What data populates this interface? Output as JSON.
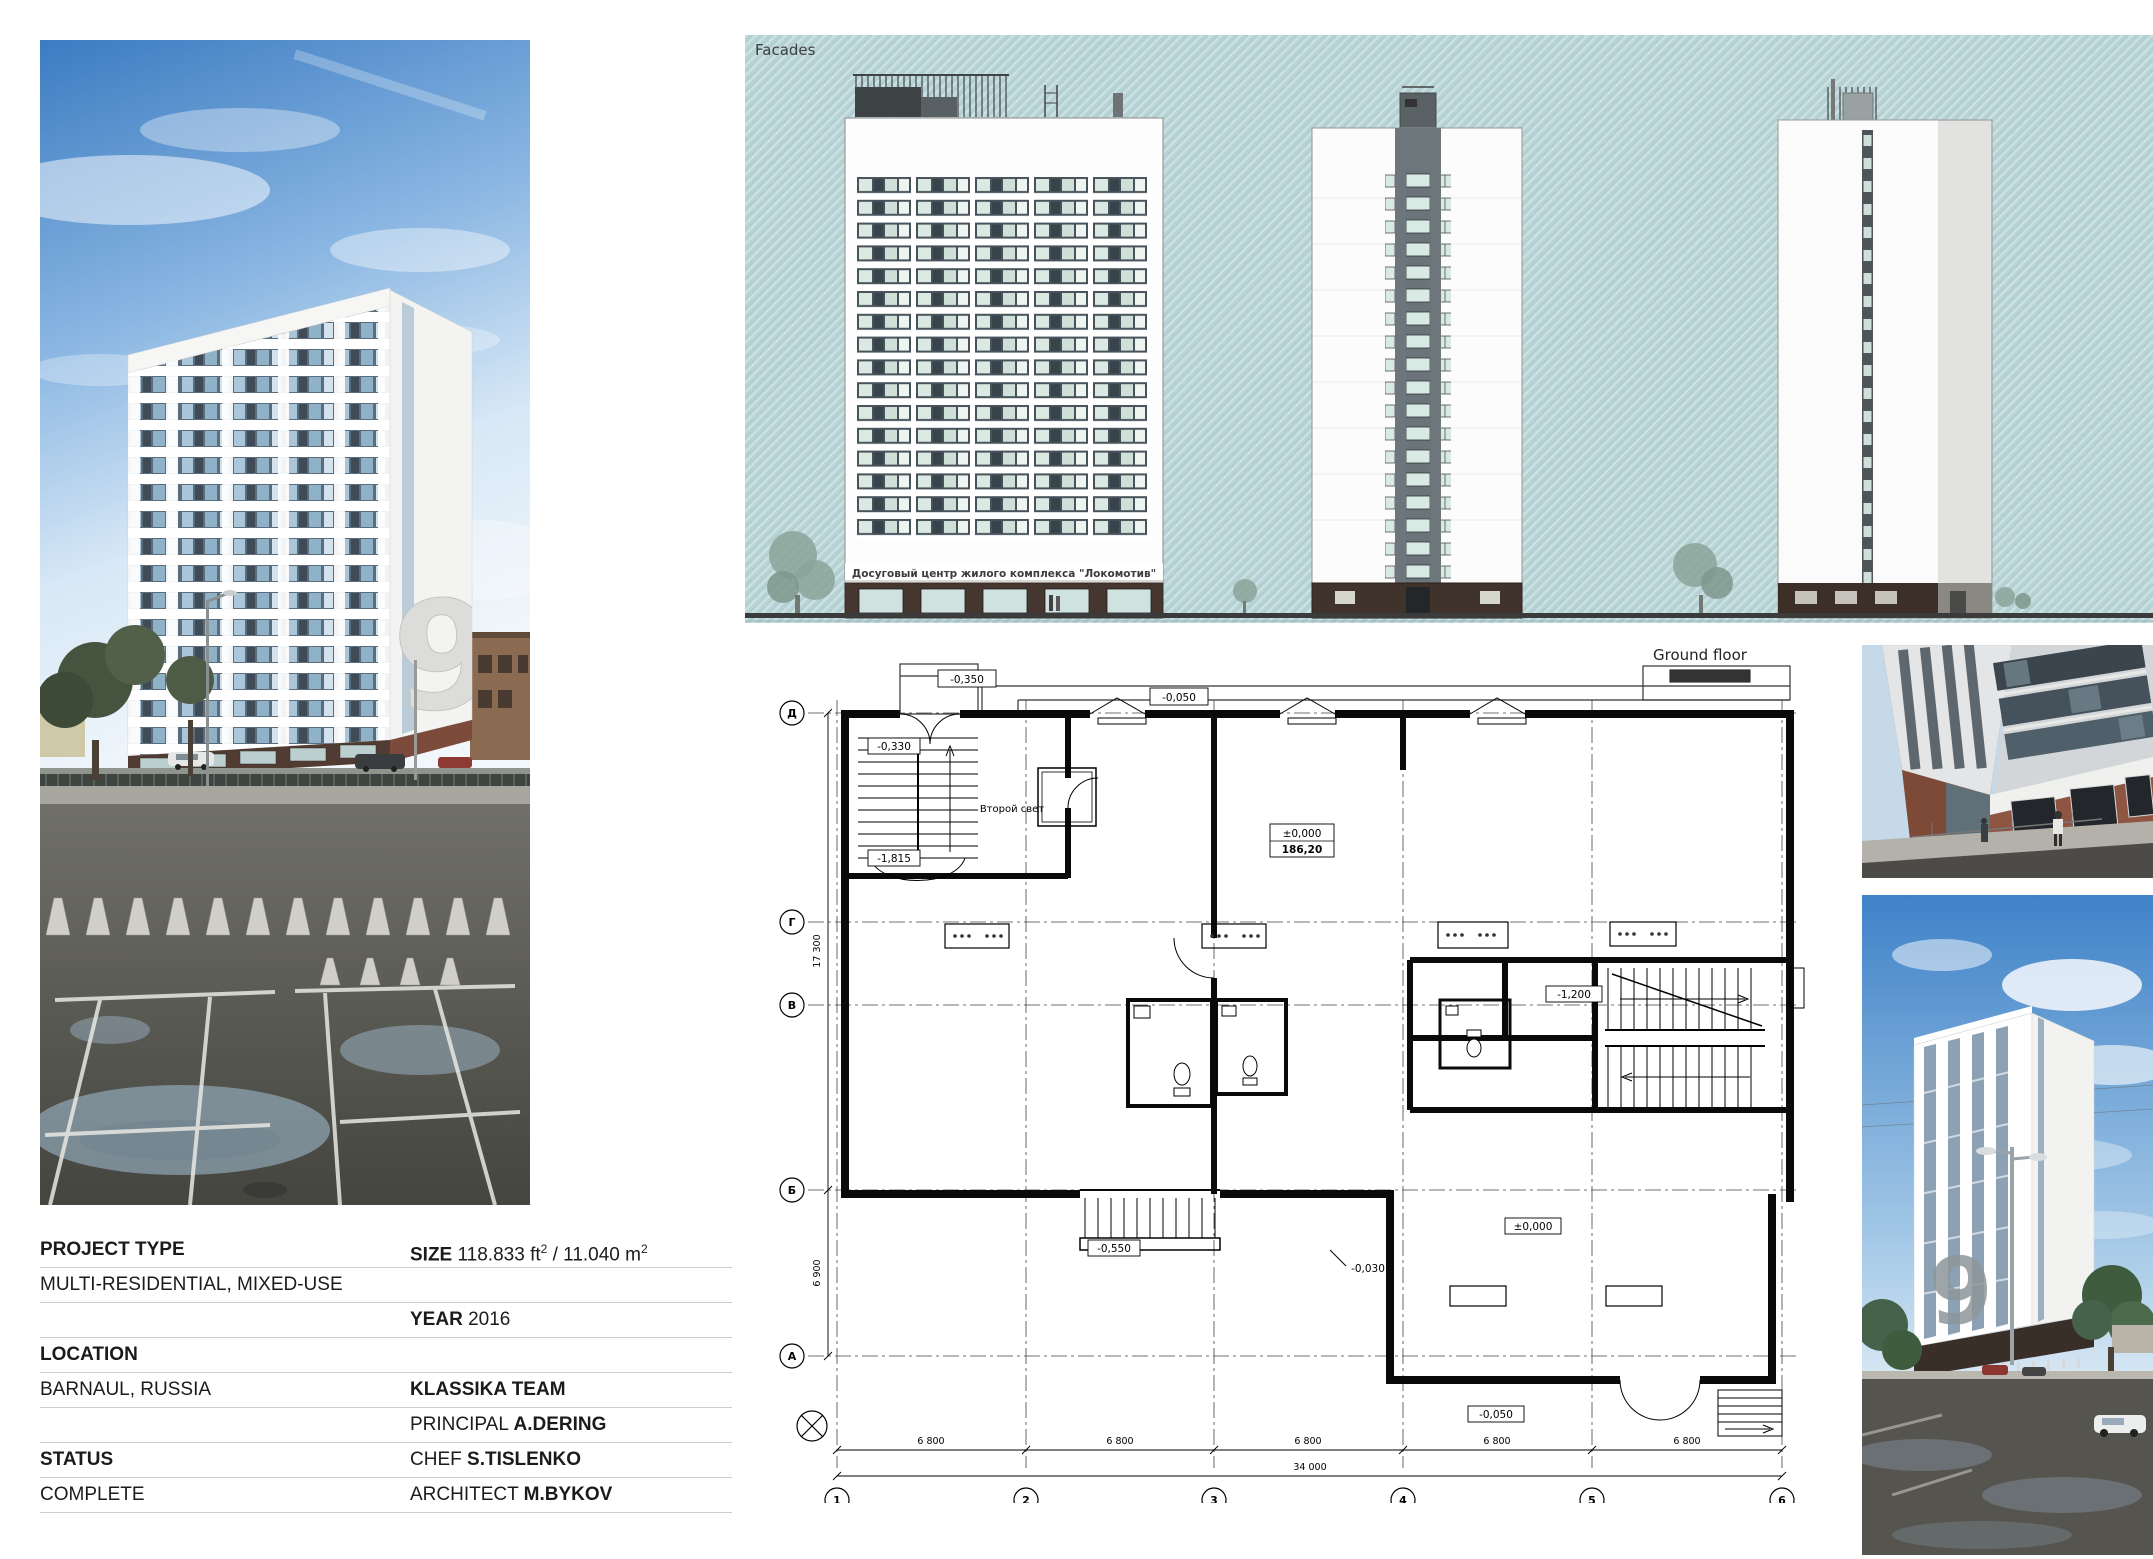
{
  "facades": {
    "title": "Facades",
    "caption": "Досуговый центр жилого комплекса \"Локомотив\""
  },
  "plan": {
    "title": "Ground floor",
    "room_label": "Второй свет",
    "levels": {
      "l1": "-0,350",
      "l2": "-0,050",
      "l3": "-0,330",
      "l4": "-1,815",
      "l5": "±0,000",
      "l5b": "186,20",
      "l6": "-1,200",
      "l7": "-0,550",
      "l8": "-0,030",
      "l9": "±0,000",
      "l10": "-0,050"
    },
    "grid_rows": [
      "Д",
      "Г",
      "В",
      "Б",
      "А"
    ],
    "grid_cols": [
      "1",
      "2",
      "3",
      "4",
      "5",
      "6"
    ],
    "dims": {
      "bay": "6 800",
      "total": "34 000",
      "v1": "17 300",
      "v2": "6 900"
    }
  },
  "render": {
    "tower_number": "9"
  },
  "info": {
    "project_type_label": "PROJECT TYPE",
    "project_type_value": "MULTI-RESIDENTIAL, MIXED-USE",
    "size_label": "SIZE",
    "size_value_ft": "118.833 ft",
    "size_sup": "2",
    "size_sep": " / ",
    "size_value_m": "11.040 m",
    "year_label": "YEAR",
    "year_value": "2016",
    "location_label": "LOCATION",
    "location_value": "BARNAUL, RUSSIA",
    "team": "KLASSIKA TEAM",
    "principal_label": "PRINCIPAL",
    "principal_value": "A.DERING",
    "chef_label": "CHEF",
    "chef_value": "S.TISLENKO",
    "architect_label": "ARCHITECT",
    "architect_value": "M.BYKOV",
    "status_label": "STATUS",
    "status_value": "COMPLETE"
  }
}
